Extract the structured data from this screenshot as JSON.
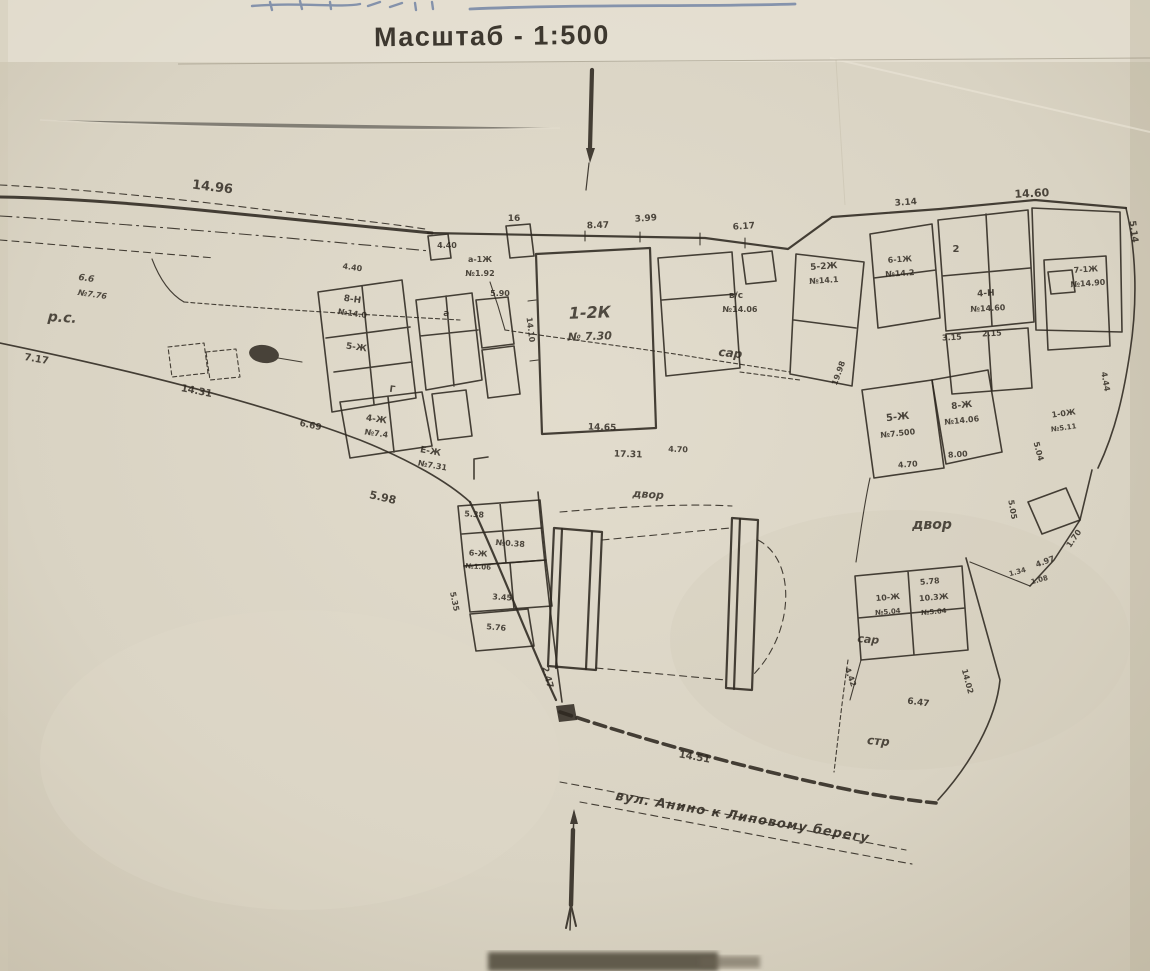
{
  "header": {
    "scale_title": "Масштаб - 1:500"
  },
  "plan": {
    "paper_color": "#d9d3c3",
    "ink_color": "#2e2820",
    "title_color": "#7e90b0",
    "street_label": "вул. Анино к Липовому берегу",
    "labels": [
      {
        "t": "14.96",
        "x": 212,
        "y": 191,
        "r": 7,
        "s": 13,
        "k": "num"
      },
      {
        "t": "8.47",
        "x": 598,
        "y": 228,
        "r": -2,
        "s": 9,
        "k": "num"
      },
      {
        "t": "3.99",
        "x": 646,
        "y": 221,
        "r": -4,
        "s": 9,
        "k": "num"
      },
      {
        "t": "6.17",
        "x": 744,
        "y": 229,
        "r": -4,
        "s": 9,
        "k": "num"
      },
      {
        "t": "3.14",
        "x": 906,
        "y": 205,
        "r": -4,
        "s": 9,
        "k": "num"
      },
      {
        "t": "14.60",
        "x": 1032,
        "y": 197,
        "r": -3,
        "s": 11,
        "k": "num"
      },
      {
        "t": "5.14",
        "x": 1131,
        "y": 232,
        "r": 82,
        "s": 9,
        "k": "num"
      },
      {
        "t": "р.с.",
        "x": 62,
        "y": 322,
        "r": 4,
        "s": 14,
        "k": "cur"
      },
      {
        "t": "6.6",
        "x": 86,
        "y": 281,
        "r": 8,
        "s": 9,
        "k": "cur"
      },
      {
        "t": "№7.76",
        "x": 92,
        "y": 297,
        "r": 8,
        "s": 8,
        "k": "cur"
      },
      {
        "t": "7.17",
        "x": 36,
        "y": 362,
        "r": 10,
        "s": 10,
        "k": "num"
      },
      {
        "t": "14.31",
        "x": 196,
        "y": 394,
        "r": 11,
        "s": 10,
        "k": "num"
      },
      {
        "t": "6.69",
        "x": 310,
        "y": 428,
        "r": 12,
        "s": 9,
        "k": "num"
      },
      {
        "t": "5.98",
        "x": 382,
        "y": 501,
        "r": 13,
        "s": 11,
        "k": "num"
      },
      {
        "t": "4.40",
        "x": 352,
        "y": 270,
        "r": 8,
        "s": 8,
        "k": "num"
      },
      {
        "t": "8-Н",
        "x": 352,
        "y": 302,
        "r": 8,
        "s": 9,
        "k": "num"
      },
      {
        "t": "№14.0",
        "x": 352,
        "y": 316,
        "r": 8,
        "s": 8,
        "k": "num"
      },
      {
        "t": "5-Ж",
        "x": 356,
        "y": 350,
        "r": 8,
        "s": 9,
        "k": "num"
      },
      {
        "t": "а",
        "x": 446,
        "y": 316,
        "r": 8,
        "s": 9,
        "k": "num"
      },
      {
        "t": "Г",
        "x": 392,
        "y": 392,
        "r": 8,
        "s": 9,
        "k": "num"
      },
      {
        "t": "4-Ж",
        "x": 376,
        "y": 422,
        "r": 8,
        "s": 9,
        "k": "num"
      },
      {
        "t": "№7.4",
        "x": 376,
        "y": 436,
        "r": 8,
        "s": 8,
        "k": "num"
      },
      {
        "t": "Е-Ж",
        "x": 430,
        "y": 454,
        "r": 10,
        "s": 9,
        "k": "num"
      },
      {
        "t": "№7.31",
        "x": 432,
        "y": 468,
        "r": 10,
        "s": 8,
        "k": "num"
      },
      {
        "t": "а-1Ж",
        "x": 480,
        "y": 262,
        "r": 0,
        "s": 8,
        "k": "num"
      },
      {
        "t": "№1.92",
        "x": 480,
        "y": 276,
        "r": 0,
        "s": 8,
        "k": "num"
      },
      {
        "t": "16",
        "x": 514,
        "y": 221,
        "r": 0,
        "s": 9,
        "k": "num"
      },
      {
        "t": "4.40",
        "x": 447,
        "y": 248,
        "r": 0,
        "s": 8,
        "k": "num"
      },
      {
        "t": "5.90",
        "x": 500,
        "y": 296,
        "r": 0,
        "s": 8,
        "k": "num"
      },
      {
        "t": "1-2К",
        "x": 590,
        "y": 318,
        "r": -2,
        "s": 16,
        "k": "cur"
      },
      {
        "t": "№ 7.30",
        "x": 590,
        "y": 340,
        "r": -2,
        "s": 11,
        "k": "cur"
      },
      {
        "t": "14.10",
        "x": 528,
        "y": 330,
        "r": 83,
        "s": 8,
        "k": "num"
      },
      {
        "t": "14.65",
        "x": 602,
        "y": 430,
        "r": 2,
        "s": 9,
        "k": "num"
      },
      {
        "t": "17.31",
        "x": 628,
        "y": 457,
        "r": 2,
        "s": 9,
        "k": "num"
      },
      {
        "t": "4.70",
        "x": 678,
        "y": 452,
        "r": 2,
        "s": 8,
        "k": "num"
      },
      {
        "t": "двор",
        "x": 648,
        "y": 498,
        "r": 4,
        "s": 11,
        "k": "cur"
      },
      {
        "t": "в/с",
        "x": 736,
        "y": 298,
        "r": 0,
        "s": 9,
        "k": "num"
      },
      {
        "t": "№14.06",
        "x": 740,
        "y": 312,
        "r": 0,
        "s": 8,
        "k": "num"
      },
      {
        "t": "сар",
        "x": 730,
        "y": 357,
        "r": 6,
        "s": 12,
        "k": "cur"
      },
      {
        "t": "5-2Ж",
        "x": 824,
        "y": 269,
        "r": -4,
        "s": 9,
        "k": "num"
      },
      {
        "t": "№14.1",
        "x": 824,
        "y": 283,
        "r": -4,
        "s": 8,
        "k": "num"
      },
      {
        "t": "19.98",
        "x": 841,
        "y": 374,
        "r": -70,
        "s": 8,
        "k": "num"
      },
      {
        "t": "6-1Ж",
        "x": 900,
        "y": 262,
        "r": -4,
        "s": 8,
        "k": "num"
      },
      {
        "t": "№14.2",
        "x": 900,
        "y": 276,
        "r": -4,
        "s": 8,
        "k": "num"
      },
      {
        "t": "2",
        "x": 956,
        "y": 252,
        "r": 0,
        "s": 10,
        "k": "num"
      },
      {
        "t": "4-Н",
        "x": 986,
        "y": 296,
        "r": -3,
        "s": 9,
        "k": "num"
      },
      {
        "t": "№14.60",
        "x": 988,
        "y": 311,
        "r": -3,
        "s": 8,
        "k": "num"
      },
      {
        "t": "3.15",
        "x": 952,
        "y": 340,
        "r": -3,
        "s": 8,
        "k": "num"
      },
      {
        "t": "2.15",
        "x": 992,
        "y": 336,
        "r": -3,
        "s": 8,
        "k": "num"
      },
      {
        "t": "7-1Ж",
        "x": 1086,
        "y": 272,
        "r": -4,
        "s": 8,
        "k": "num"
      },
      {
        "t": "№14.90",
        "x": 1088,
        "y": 286,
        "r": -4,
        "s": 8,
        "k": "num"
      },
      {
        "t": "4.44",
        "x": 1103,
        "y": 382,
        "r": 80,
        "s": 8,
        "k": "num"
      },
      {
        "t": "5-Ж",
        "x": 898,
        "y": 420,
        "r": -6,
        "s": 10,
        "k": "num"
      },
      {
        "t": "№7.500",
        "x": 898,
        "y": 436,
        "r": -6,
        "s": 8,
        "k": "num"
      },
      {
        "t": "4.70",
        "x": 908,
        "y": 467,
        "r": -4,
        "s": 8,
        "k": "num"
      },
      {
        "t": "8-Ж",
        "x": 962,
        "y": 408,
        "r": -6,
        "s": 9,
        "k": "num"
      },
      {
        "t": "№14.06",
        "x": 962,
        "y": 423,
        "r": -6,
        "s": 8,
        "k": "num"
      },
      {
        "t": "8.00",
        "x": 958,
        "y": 457,
        "r": -4,
        "s": 8,
        "k": "num"
      },
      {
        "t": "1-0Ж",
        "x": 1064,
        "y": 416,
        "r": -8,
        "s": 8,
        "k": "num"
      },
      {
        "t": "№5.11",
        "x": 1064,
        "y": 430,
        "r": -8,
        "s": 7,
        "k": "num"
      },
      {
        "t": "5.04",
        "x": 1036,
        "y": 452,
        "r": 75,
        "s": 8,
        "k": "num"
      },
      {
        "t": "5.05",
        "x": 1010,
        "y": 510,
        "r": 80,
        "s": 8,
        "k": "num"
      },
      {
        "t": "1.70",
        "x": 1076,
        "y": 540,
        "r": -55,
        "s": 8,
        "k": "num"
      },
      {
        "t": "4.97",
        "x": 1046,
        "y": 564,
        "r": -20,
        "s": 8,
        "k": "num"
      },
      {
        "t": "1.34",
        "x": 1018,
        "y": 574,
        "r": -15,
        "s": 7,
        "k": "num"
      },
      {
        "t": "1.08",
        "x": 1040,
        "y": 582,
        "r": -15,
        "s": 7,
        "k": "num"
      },
      {
        "t": "двор",
        "x": 932,
        "y": 529,
        "r": 0,
        "s": 14,
        "k": "cur"
      },
      {
        "t": "5.38",
        "x": 474,
        "y": 517,
        "r": 4,
        "s": 8,
        "k": "num"
      },
      {
        "t": "№0.38",
        "x": 510,
        "y": 546,
        "r": 4,
        "s": 8,
        "k": "num"
      },
      {
        "t": "6-Ж",
        "x": 478,
        "y": 556,
        "r": 4,
        "s": 8,
        "k": "num"
      },
      {
        "t": "№1.06",
        "x": 478,
        "y": 569,
        "r": 4,
        "s": 7,
        "k": "num"
      },
      {
        "t": "5.35",
        "x": 452,
        "y": 602,
        "r": 78,
        "s": 8,
        "k": "num"
      },
      {
        "t": "3.45",
        "x": 502,
        "y": 600,
        "r": 4,
        "s": 8,
        "k": "num"
      },
      {
        "t": "5.76",
        "x": 496,
        "y": 630,
        "r": 5,
        "s": 8,
        "k": "num"
      },
      {
        "t": "2.47",
        "x": 545,
        "y": 678,
        "r": 75,
        "s": 9,
        "k": "num"
      },
      {
        "t": "14.51",
        "x": 694,
        "y": 760,
        "r": 10,
        "s": 10,
        "k": "num"
      },
      {
        "t": "10-Ж",
        "x": 888,
        "y": 600,
        "r": -5,
        "s": 8,
        "k": "num"
      },
      {
        "t": "№5.04",
        "x": 888,
        "y": 614,
        "r": -5,
        "s": 7,
        "k": "num"
      },
      {
        "t": "10.3Ж",
        "x": 934,
        "y": 600,
        "r": -5,
        "s": 8,
        "k": "num"
      },
      {
        "t": "№5.04",
        "x": 934,
        "y": 614,
        "r": -5,
        "s": 7,
        "k": "num"
      },
      {
        "t": "5.78",
        "x": 930,
        "y": 584,
        "r": -5,
        "s": 8,
        "k": "num"
      },
      {
        "t": "сар",
        "x": 868,
        "y": 643,
        "r": 5,
        "s": 11,
        "k": "cur"
      },
      {
        "t": "4.42",
        "x": 848,
        "y": 678,
        "r": 70,
        "s": 8,
        "k": "num"
      },
      {
        "t": "6.47",
        "x": 918,
        "y": 705,
        "r": 8,
        "s": 9,
        "k": "num"
      },
      {
        "t": "14.02",
        "x": 965,
        "y": 682,
        "r": 75,
        "s": 8,
        "k": "num"
      },
      {
        "t": "стр",
        "x": 878,
        "y": 745,
        "r": 5,
        "s": 12,
        "k": "cur"
      },
      {
        "t": "вул. Анино к Липовому берегу",
        "x": 742,
        "y": 821,
        "r": 9.5,
        "s": 13,
        "k": "street"
      }
    ]
  }
}
